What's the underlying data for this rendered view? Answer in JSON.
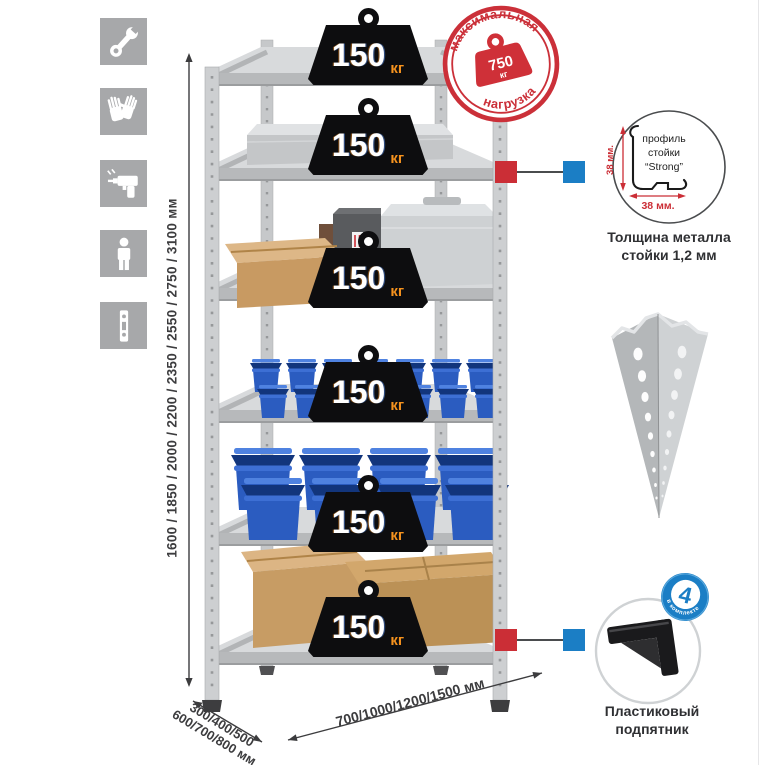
{
  "colors": {
    "icon_tile": "#a7a8aa",
    "accent_red": "#cb2e36",
    "accent_blue": "#1b7ec5",
    "bin_blue": "#2b5cc0",
    "cardboard": "#c89a62",
    "metal_light": "#d8dadc",
    "badge_black": "#0d0d0f",
    "kg_orange": "#f5921e",
    "text_dark": "#3c3c3e"
  },
  "sidebar_icons": [
    {
      "name": "wrench-icon"
    },
    {
      "name": "gloves-icon"
    },
    {
      "name": "drill-icon"
    },
    {
      "name": "person-icon"
    },
    {
      "name": "perforated-post-icon"
    }
  ],
  "height_dimension": {
    "label": "1600 / 1850 / 2000 / 2200 / 2350 / 2550 / 2750 / 3100 мм"
  },
  "shelf_badges": {
    "items": [
      {
        "value": "150",
        "unit": "кг"
      },
      {
        "value": "150",
        "unit": "кг"
      },
      {
        "value": "150",
        "unit": "кг"
      },
      {
        "value": "150",
        "unit": "кг"
      },
      {
        "value": "150",
        "unit": "кг"
      },
      {
        "value": "150",
        "unit": "кг"
      }
    ]
  },
  "max_load_stamp": {
    "arc_top": "максимальная",
    "arc_bottom": "нагрузка",
    "value": "750",
    "unit": "кг"
  },
  "profile_callout": {
    "label_line1": "профиль",
    "label_line2": "стойки",
    "label_line3": "“Strong”",
    "dim_vertical": "38 мм.",
    "dim_horizontal": "38 мм.",
    "caption_line1": "Толщина металла",
    "caption_line2": "стойки 1,2 мм"
  },
  "included_badge": {
    "value": "4",
    "arc_text": "в комплекте"
  },
  "foot_callout": {
    "caption_line1": "Пластиковый",
    "caption_line2": "подпятник"
  },
  "depth_dimension": {
    "line1": "300/400/500",
    "line2": "600/700/800 мм"
  },
  "width_dimension": {
    "label": "700/1000/1200/1500 мм"
  }
}
